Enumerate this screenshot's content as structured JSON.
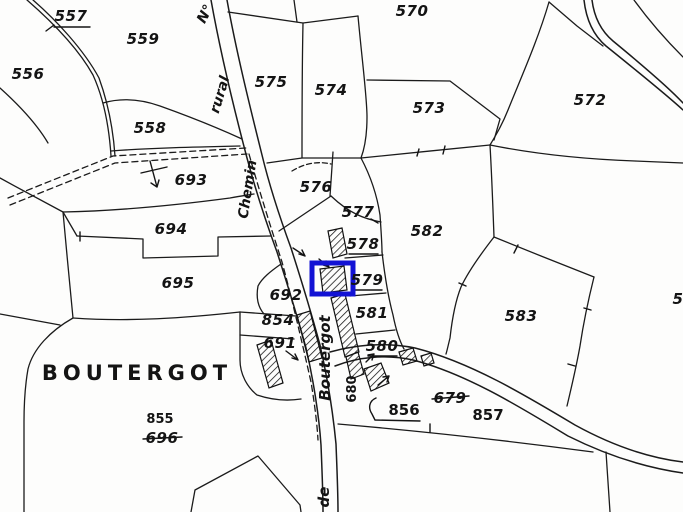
{
  "map": {
    "place_label": "BOUTERGOT",
    "highlight_color": "#1212d4",
    "line_color": "#1b1b1b",
    "background_color": "#fdfdfc",
    "streets": {
      "road_number": "N°",
      "rural": "rural",
      "chemin": "Chemin",
      "boutergot": "Boutergot",
      "de": "de"
    },
    "parcels": {
      "p557": {
        "number": "557",
        "underlined": true
      },
      "p559": {
        "number": "559"
      },
      "p556": {
        "number": "556"
      },
      "p558": {
        "number": "558"
      },
      "p570": {
        "number": "570"
      },
      "p575": {
        "number": "575"
      },
      "p574": {
        "number": "574"
      },
      "p573": {
        "number": "573"
      },
      "p572": {
        "number": "572"
      },
      "p693": {
        "number": "693"
      },
      "p694": {
        "number": "694"
      },
      "p695": {
        "number": "695"
      },
      "p576": {
        "number": "576"
      },
      "p577": {
        "number": "577"
      },
      "p578": {
        "number": "578",
        "underlined": true
      },
      "p582": {
        "number": "582"
      },
      "p579": {
        "number": "579",
        "underlined": true
      },
      "p581": {
        "number": "581"
      },
      "p583": {
        "number": "583"
      },
      "p692": {
        "number": "692"
      },
      "p854": {
        "number": "854"
      },
      "p691": {
        "number": "691"
      },
      "p580": {
        "number": "580",
        "underlined": true
      },
      "p680": {
        "number": "680"
      },
      "p856": {
        "number": "856"
      },
      "p679": {
        "number": "679",
        "struck": true
      },
      "p857": {
        "number": "857"
      },
      "p855": {
        "number": "855"
      },
      "p696": {
        "number": "696",
        "struck": true
      },
      "p5_partial": {
        "number": "5"
      }
    }
  }
}
